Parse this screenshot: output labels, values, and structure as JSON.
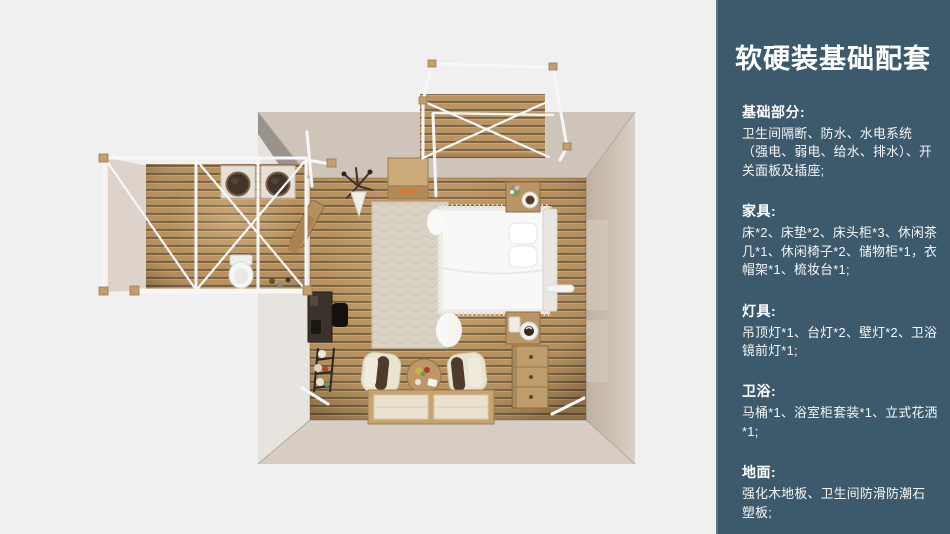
{
  "page": {
    "width": 950,
    "height": 534,
    "background": "#f0f0f0"
  },
  "panel": {
    "background": "#3d5a6c",
    "edge_highlight": "#5b7482",
    "text_color": "#ffffff",
    "title": "软硬装基础配套",
    "sections": [
      {
        "heading": "基础部分:",
        "body": "卫生间隔断、防水、水电系统（强电、弱电、给水、排水）、开关面板及插座;"
      },
      {
        "heading": "家具:",
        "body": "床*2、床垫*2、床头柜*3、休闲茶几*1、休闲椅子*2、储物柜*1，衣帽架*1、梳妆台*1;"
      },
      {
        "heading": "灯具:",
        "body": "吊顶灯*1、台灯*2、壁灯*2、卫浴镜前灯*1;"
      },
      {
        "heading": "卫浴:",
        "body": "马桶*1、浴室柜套装*1、立式花洒*1;"
      },
      {
        "heading": "地面:",
        "body": "强化木地板、卫生间防滑防潮石塑板;"
      }
    ]
  },
  "floorplan": {
    "view": "top-down-3d-render",
    "rooms": [
      "bedroom",
      "bathroom-wing",
      "entrance-deck"
    ],
    "objects": [
      "double-bed",
      "pillows",
      "headboard",
      "rug",
      "nightstand",
      "coffee-cup",
      "flower-pot",
      "dresser",
      "storage-cabinet",
      "coat-rack",
      "dressing-desk",
      "desk-chair",
      "plant-stand",
      "armchair",
      "round-tea-table",
      "floor-mats",
      "wash-basin",
      "toilet",
      "tent-frame",
      "wall-lamp"
    ],
    "colors": {
      "background": "#f0f0f0",
      "wall_top": "#cfc4b9",
      "wall_lit": "#e7e3df",
      "wall_shade": "#c2b4a6",
      "floor_wood": "#b78c55",
      "floor_gap": "#534d46",
      "frame_white": "#f7f7f9",
      "bed_white": "#f8f8f9",
      "rug": "#d9d2c5",
      "wood_furniture": "#bf9c6c",
      "handle_orange": "#d97b35"
    }
  }
}
